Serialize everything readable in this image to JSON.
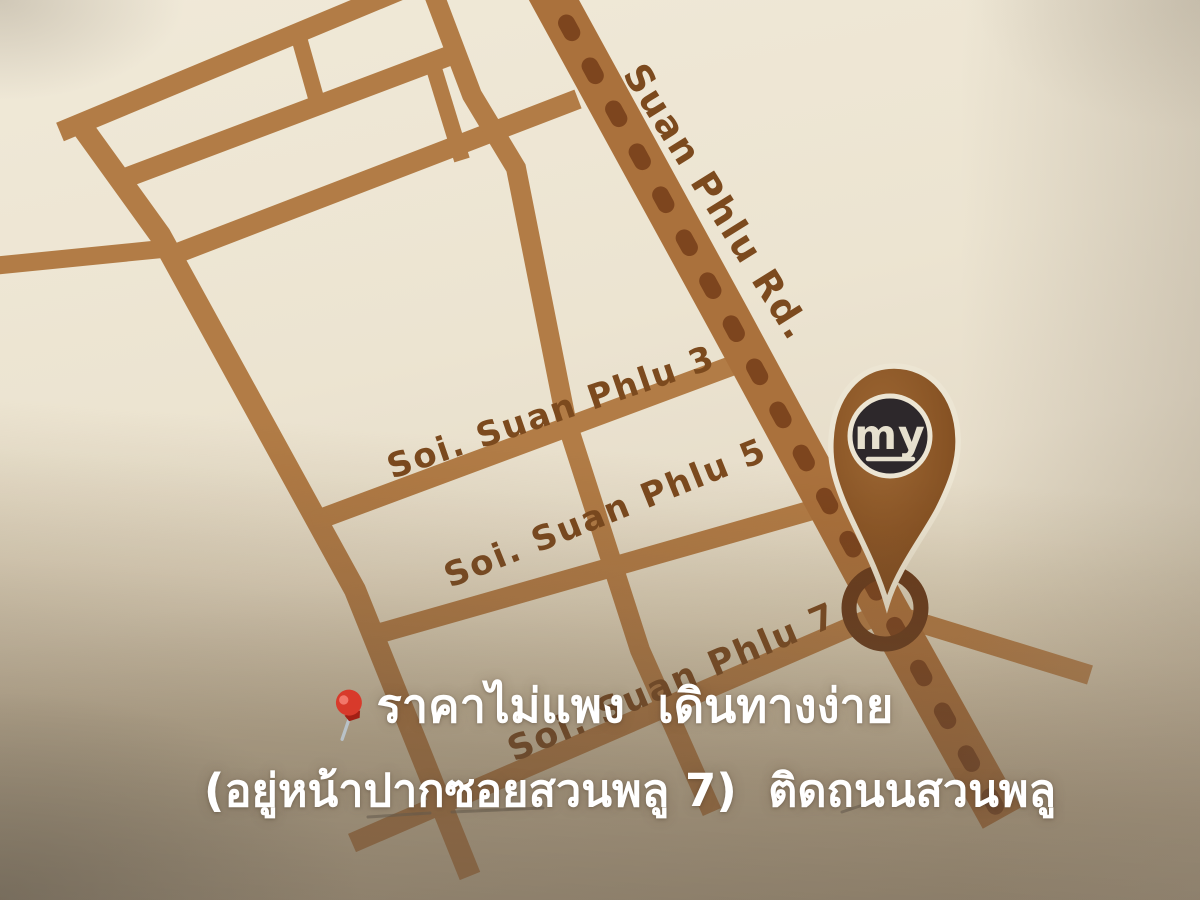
{
  "map": {
    "road_label": "Suan Phlu Rd.",
    "sois": [
      {
        "label": "Soi. Suan Phlu 3"
      },
      {
        "label": "Soi. Suan Phlu 5"
      },
      {
        "label": "Soi. Suan Phlu 7"
      }
    ],
    "marker": {
      "logo_text": "my"
    },
    "colors": {
      "street": "#b27c46",
      "road": "#aa713c",
      "road_dash": "#7d451e",
      "label": "#7c4a1e",
      "ring": "#6b3d1c",
      "pin": "#845022",
      "pin_light": "#9d6733",
      "pin_outline": "#ece5d3",
      "logo_bg": "#2d282b",
      "logo_text": "#e6e0ce",
      "background": "#ece4d1",
      "caption_text": "#ffffff",
      "pushpin_red": "#d83a2b"
    }
  },
  "caption": {
    "line1": "ราคาไม่แพง  เดินทางง่าย",
    "line2": "(อยู่หน้าปากซอยสวนพลู 7)  ติดถนนสวนพลู"
  }
}
